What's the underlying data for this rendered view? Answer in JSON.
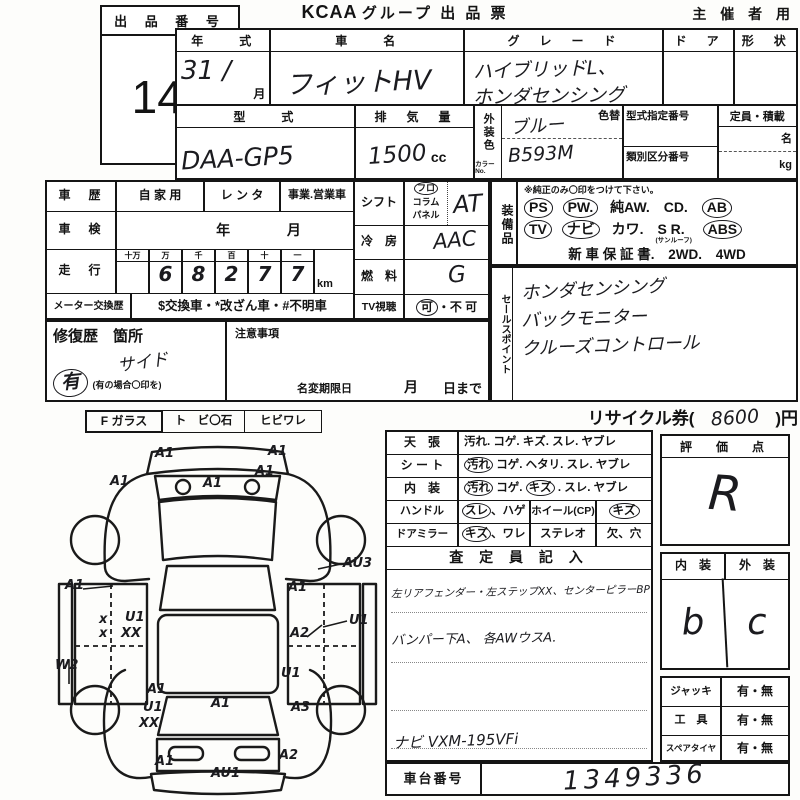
{
  "header": {
    "lot_label": "出 品 番 号",
    "lot_number": "143",
    "title_logo": "KCAA",
    "title_rest": "グループ 出 品 票",
    "corner": "主 催 者 用"
  },
  "vehicle": {
    "year_label": "年　　式",
    "year_value": "31 /",
    "month": "月",
    "name_label": "車　　名",
    "name_value": "フィットHV",
    "grade_label": "グ　レ　ー　ド",
    "grade_line1": "ハイブリッドL、",
    "grade_line2": "ホンダセンシング",
    "door_label": "ド　ア",
    "shape_label": "形　状",
    "model_label": "型　　式",
    "model_value": "DAA-GP5",
    "displacement_label": "排　気　量",
    "displacement_value": "1500",
    "displacement_unit": "cc",
    "ext_color_label": "外装色",
    "color_no_label": "カラーNo.",
    "recolor_label": "色替",
    "color_value": "ブルー",
    "color_no_value": "B593M",
    "type_cert_label": "型式指定番号",
    "class_no_label": "類別区分番号",
    "capacity_label": "定員・積載",
    "capacity_persons": "名",
    "capacity_weight": "kg"
  },
  "history": {
    "car_history_label": "車　歴",
    "owner_private": "自 家 用",
    "owner_rental": "レ ン タ",
    "owner_business": "事業.営業車",
    "inspection_label": "車　検",
    "inspection_year": "年",
    "inspection_month": "月",
    "odometer_label": "走　行",
    "digit_headers": [
      "十万",
      "万",
      "千",
      "百",
      "十",
      "一"
    ],
    "digits": [
      "",
      "6",
      "8",
      "2",
      "7",
      "7"
    ],
    "odometer_unit": "km",
    "meter_label": "メーター交換歴",
    "meter_note": "$交換車・*改ざん車・#不明車"
  },
  "controls": {
    "shift_label": "シフト",
    "shift_floor": "フロ",
    "shift_column": "コラム",
    "shift_panel": "パネル",
    "shift_value": "AT",
    "ac_label": "冷　房",
    "ac_value": "AAC",
    "fuel_label": "燃　料",
    "fuel_value": "G",
    "tv_label": "TV視聴",
    "tv_ok": "可",
    "tv_sep": "・",
    "tv_ng": "不 可"
  },
  "equipment": {
    "label": "装備品",
    "note": "※純正のみ〇印をつけて下さい。",
    "ps": "PS",
    "pw": "PW.",
    "aw": "純AW.",
    "cd": "CD.",
    "ab": "AB",
    "tv": "TV",
    "navi": "ナビ",
    "leather": "カワ.",
    "sr": "S R.",
    "sr_note": "(サンルーフ)",
    "abs": "ABS",
    "warranty": "新 車 保 証 書.",
    "wd2": "2WD.",
    "wd4": "4WD"
  },
  "sales_point": {
    "label": "セールスポイント",
    "line1": "ホンダセンシング",
    "line2": "バックモニター",
    "line3": "クルーズコントロール"
  },
  "repair": {
    "label": "修復歴　箇所",
    "note_label": "注意事項",
    "location": "サイド",
    "has": "有",
    "has_note": "(有の場合〇印を)",
    "rename_label": "名変期限日",
    "month": "月",
    "day": "日まで"
  },
  "recycle": {
    "prefix": "リサイクル券(",
    "amount": "8600",
    "suffix": ")円"
  },
  "glass": {
    "f_label": "F ガラス",
    "chip": "ト　ビ〇石",
    "crack": "ヒビワレ"
  },
  "condition": {
    "ceiling_label": "天　張",
    "ceiling_opts": "汚れ. コゲ. キズ. スレ. ヤブレ",
    "seat_label": "シ ー ト",
    "seat_opt1": "汚れ",
    "seat_rest": "コゲ. ヘタリ. スレ. ヤブレ",
    "interior_label": "内　装",
    "interior_opt1": "汚れ",
    "interior_mid": "コゲ.",
    "interior_opt2": "キズ",
    "interior_rest": ". スレ. ヤブレ",
    "handle_label": "ハンドル",
    "handle_opt1": "スレ",
    "handle_rest": "、ハゲ",
    "wheel_label": "ホイール(CP)",
    "wheel_opt": "キズ",
    "mirror_label": "ドアミラー",
    "mirror_opt1": "キズ",
    "mirror_rest": "、ワレ",
    "stereo_label": "ステレオ",
    "stereo_opt": "欠、穴"
  },
  "inspector": {
    "title": "査 定 員 記 入",
    "line1": "左リアフェンダー・左ステップXX、センターピラーBP",
    "line2": "バンパー下A、 各AWウスA.",
    "nav_line": "ナビ VXM-195VFi"
  },
  "rating": {
    "label": "評　価　点",
    "value": "R",
    "interior_label": "内　装",
    "exterior_label": "外　装",
    "interior_value": "b",
    "exterior_value": "c"
  },
  "accessories": {
    "jack_label": "ジャッキ",
    "jack_value": "有・無",
    "tools_label": "工　具",
    "tools_value": "有・無",
    "spare_label": "スペアタイヤ",
    "spare_value": "有・無"
  },
  "chassis": {
    "label": "車台番号",
    "value": "1349336"
  },
  "diagram": {
    "labels": [
      {
        "t": "A1",
        "x": 100,
        "y": 8
      },
      {
        "t": "A1",
        "x": 213,
        "y": 6
      },
      {
        "t": "A1",
        "x": 55,
        "y": 36
      },
      {
        "t": "A1",
        "x": 148,
        "y": 38
      },
      {
        "t": "A1",
        "x": 200,
        "y": 26
      },
      {
        "t": "A1",
        "x": 10,
        "y": 140
      },
      {
        "t": "AU3",
        "x": 288,
        "y": 118
      },
      {
        "t": "A1",
        "x": 233,
        "y": 142
      },
      {
        "t": "U1",
        "x": 294,
        "y": 175
      },
      {
        "t": "A2",
        "x": 235,
        "y": 188
      },
      {
        "t": "x",
        "x": 44,
        "y": 174
      },
      {
        "t": "x",
        "x": 44,
        "y": 188
      },
      {
        "t": "U1",
        "x": 70,
        "y": 172
      },
      {
        "t": "XX",
        "x": 66,
        "y": 188
      },
      {
        "t": "W2",
        "x": 0,
        "y": 220
      },
      {
        "t": "U1",
        "x": 226,
        "y": 228
      },
      {
        "t": "A1",
        "x": 92,
        "y": 244
      },
      {
        "t": "U1",
        "x": 88,
        "y": 262
      },
      {
        "t": "XX",
        "x": 84,
        "y": 278
      },
      {
        "t": "A1",
        "x": 156,
        "y": 258
      },
      {
        "t": "A3",
        "x": 236,
        "y": 262
      },
      {
        "t": "A1",
        "x": 100,
        "y": 316
      },
      {
        "t": "AU1",
        "x": 156,
        "y": 328
      },
      {
        "t": "A2",
        "x": 224,
        "y": 310
      }
    ]
  }
}
